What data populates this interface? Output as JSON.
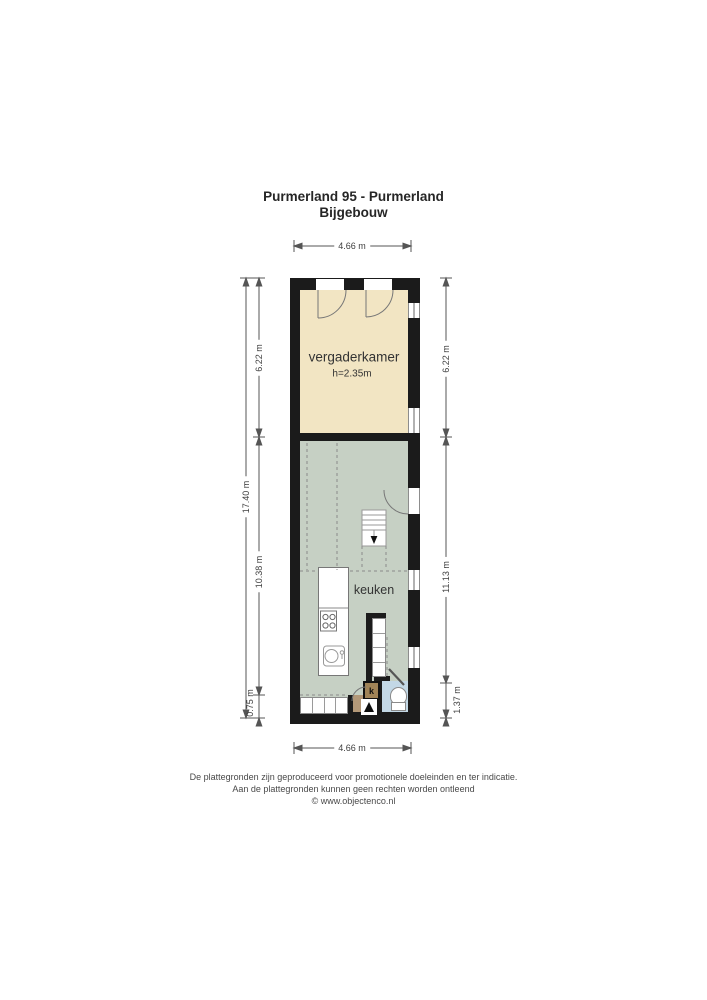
{
  "title": {
    "line1": "Purmerland 95 - Purmerland",
    "line2": "Bijgebouw"
  },
  "floorplan": {
    "rooms": {
      "vergaderkamer": {
        "label": "vergaderkamer",
        "ceiling_height": "h=2.35m"
      },
      "keuken": {
        "label": "keuken"
      },
      "closet": {
        "label": "k"
      }
    },
    "dimensions": {
      "top": "4.66 m",
      "bottom": "4.66 m",
      "left_total": "17.40 m",
      "left_top": "6.22 m",
      "left_middle": "10.38 m",
      "left_bottom": "0.75 m",
      "right_top": "6.22 m",
      "right_middle": "11.13 m",
      "right_bottom": "1.37 m"
    },
    "colors": {
      "wall": "#1b1b1b",
      "vergaderkamer_floor": "#f2e5c3",
      "keuken_floor": "#c6d0c4",
      "toilet_floor": "#c3d8e6",
      "hall_floor": "#b39878",
      "closet_fill": "#a08357",
      "dimension_lines": "#555555"
    }
  },
  "footer": {
    "line1": "De plattegronden zijn geproduceerd voor promotionele doeleinden en ter indicatie.",
    "line2": "Aan de plattegronden kunnen geen rechten worden ontleend",
    "line3": "© www.objectenco.nl"
  }
}
